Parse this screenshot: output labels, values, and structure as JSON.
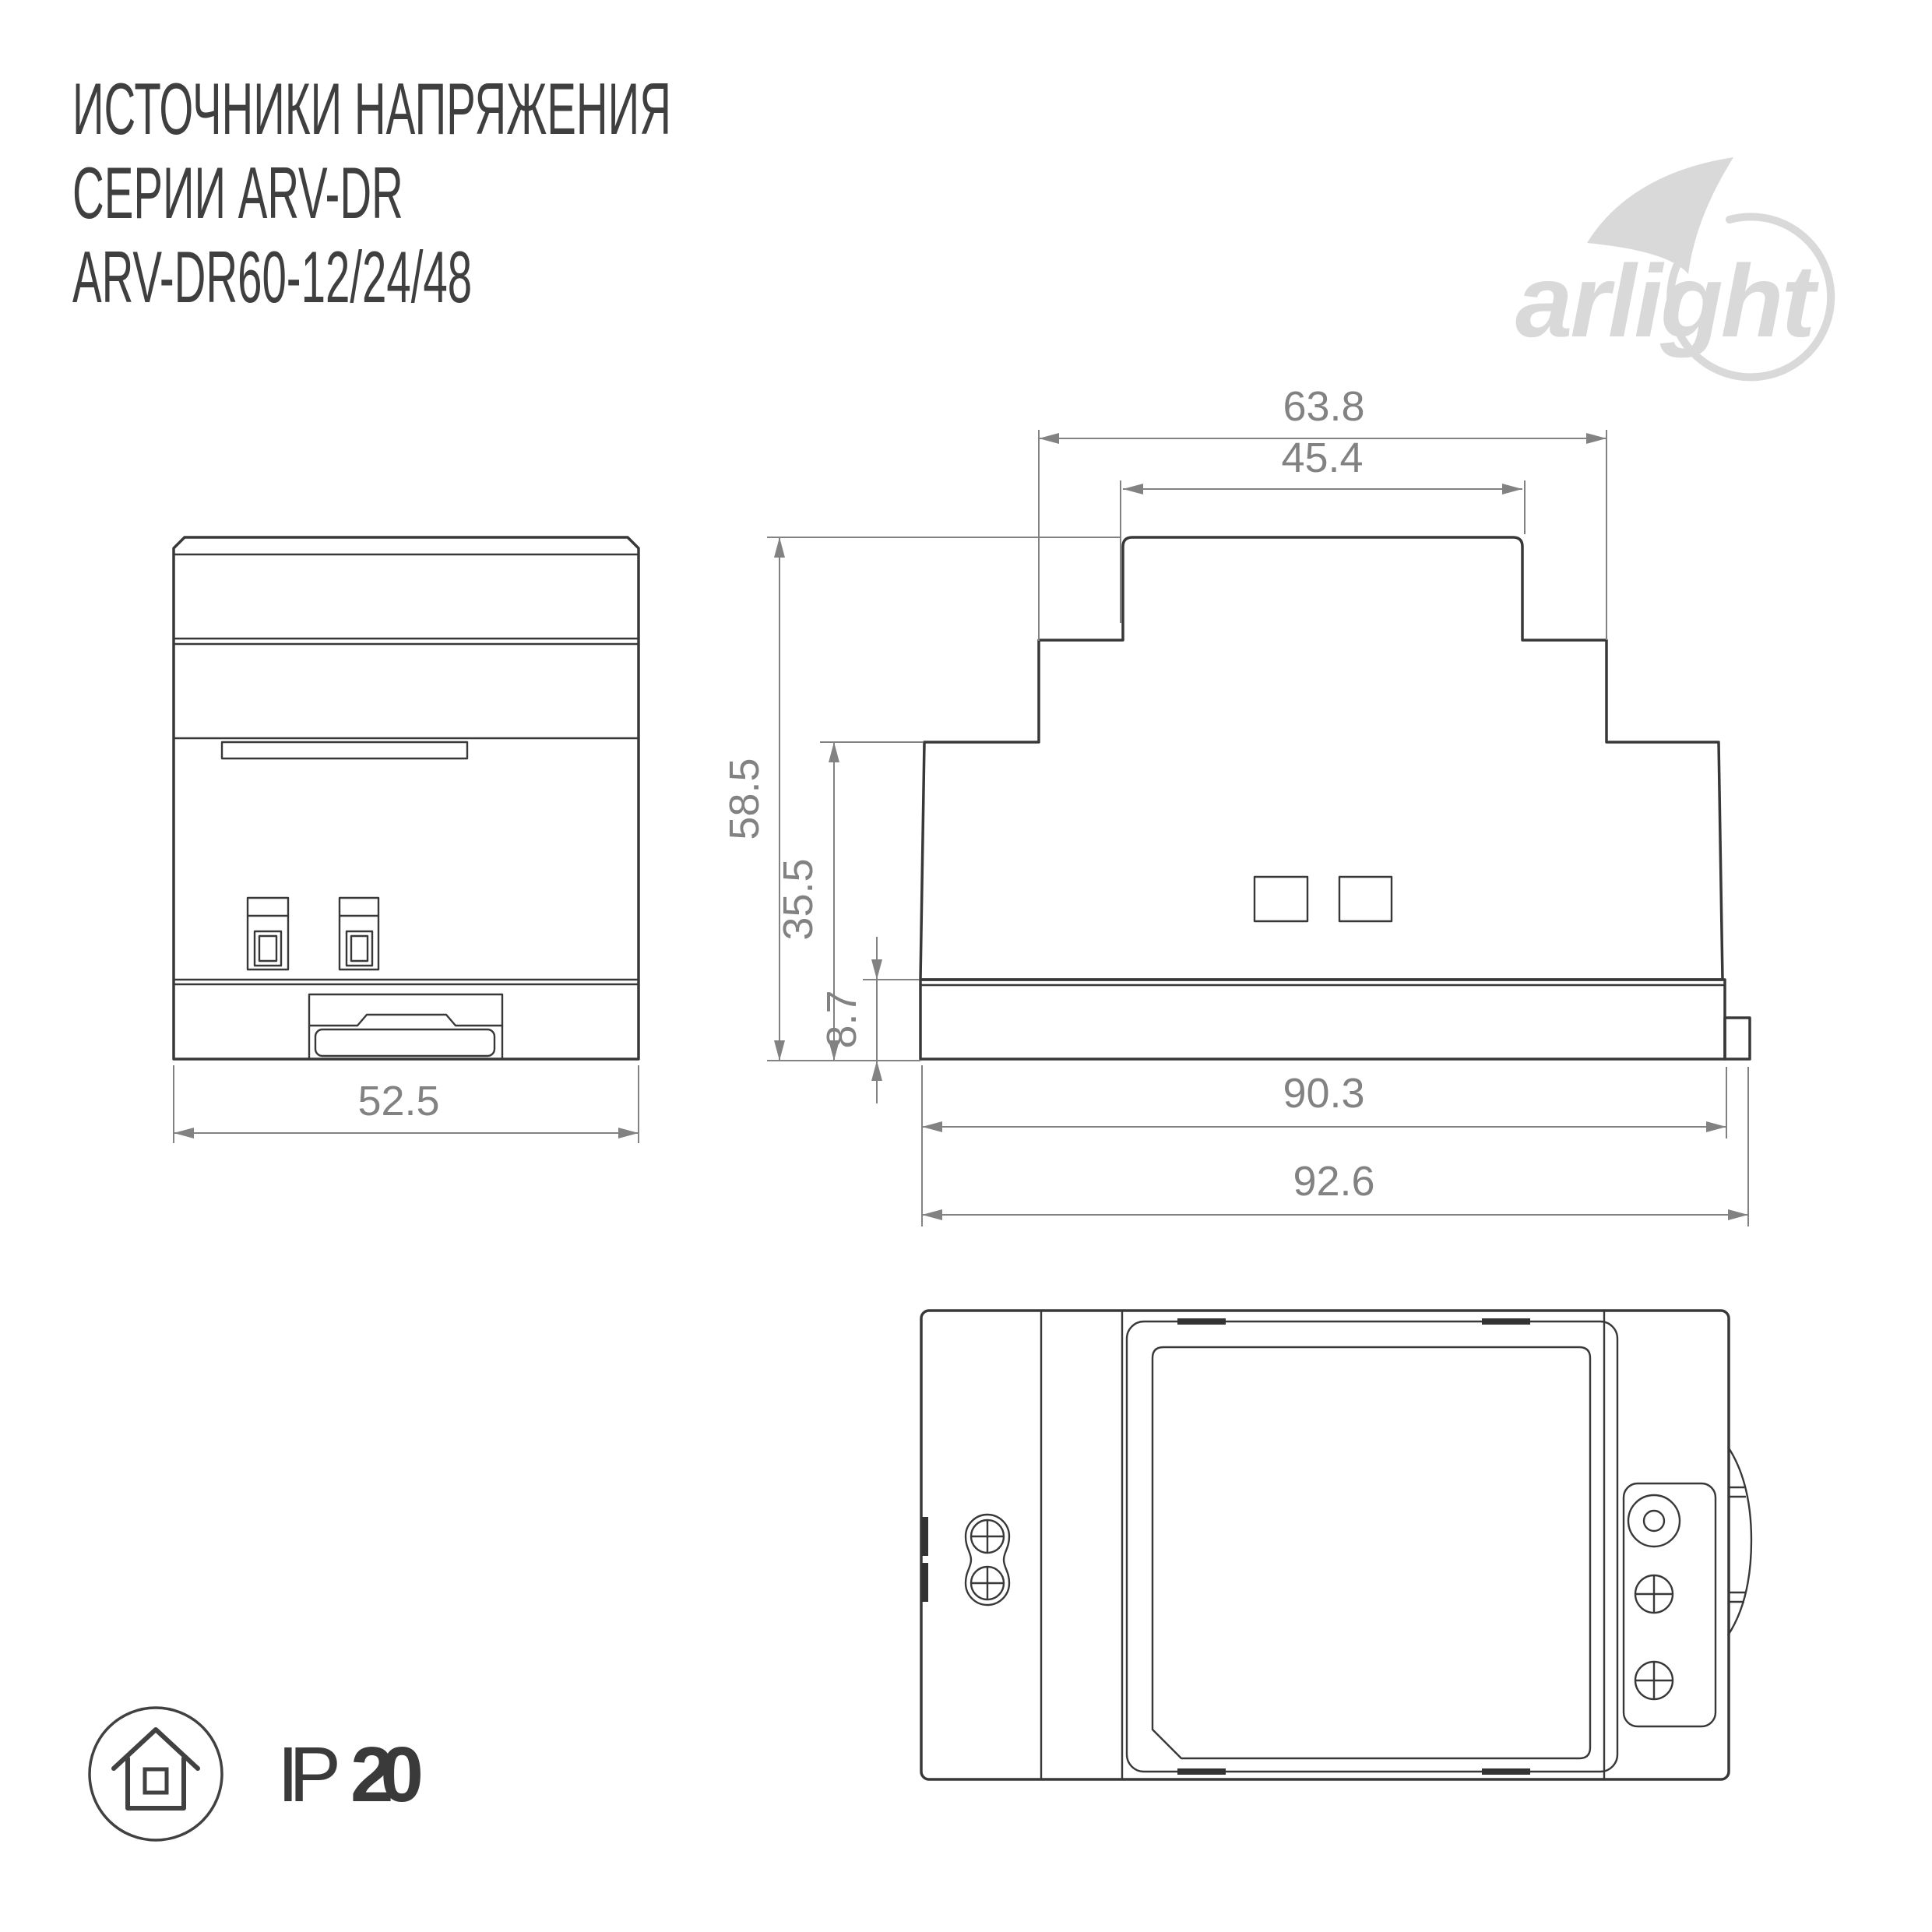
{
  "title": {
    "line1": "ИСТОЧНИКИ НАПРЯЖЕНИЯ",
    "line2": "СЕРИИ ARV-DR",
    "line3": "ARV-DR60-12/24/48"
  },
  "logo": {
    "brand": "arlight"
  },
  "dimensions": {
    "top_width": "63.8",
    "cap_width": "45.4",
    "total_height": "58.5",
    "body_height": "35.5",
    "base_height": "8.7",
    "rail_width": "90.3",
    "total_width": "92.6",
    "front_width": "52.5"
  },
  "badge": {
    "ip_prefix": "IP",
    "ip_value": "20"
  },
  "colors": {
    "line": "#383838",
    "dimension": "#828282",
    "logo": "#d9d9d9",
    "title_text": "#3f3f3f"
  }
}
